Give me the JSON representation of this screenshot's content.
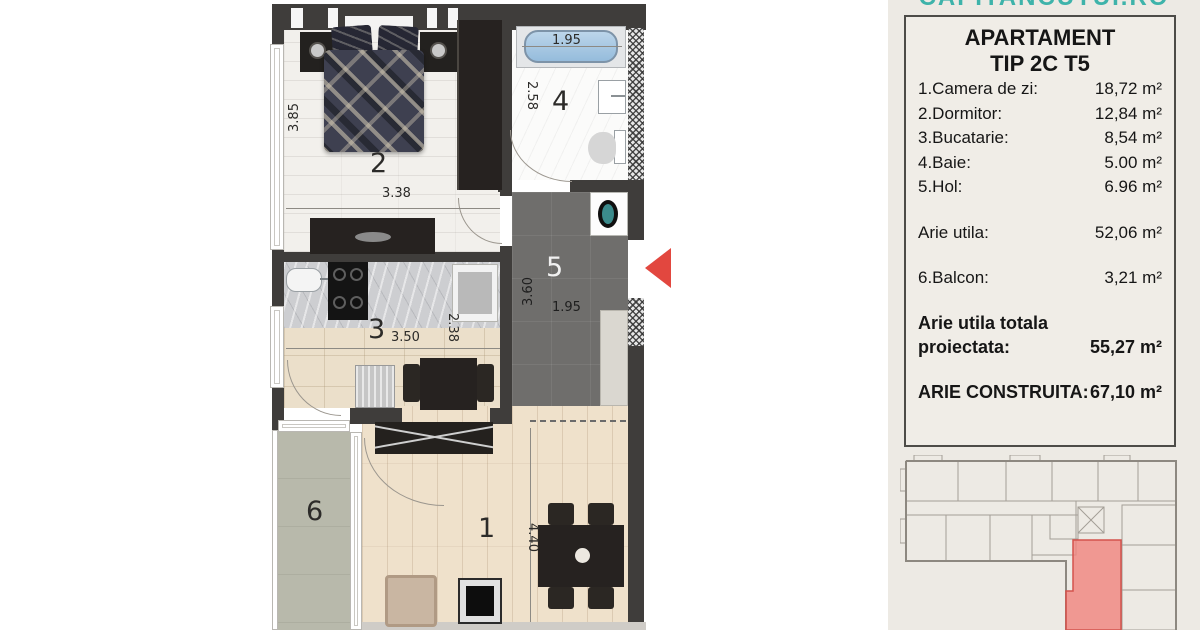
{
  "site": {
    "url_text": "CAPITANCUTUI.RO",
    "url_color": "#3eb3aa"
  },
  "panel": {
    "title_line1": "APARTAMENT",
    "title_line2": "TIP 2C T5",
    "rooms": [
      {
        "label": "1.Camera de zi:",
        "value": "18,72 m²"
      },
      {
        "label": "2.Dormitor:",
        "value": "12,84 m²"
      },
      {
        "label": "3.Bucatarie:",
        "value": "8,54 m²"
      },
      {
        "label": "4.Baie:",
        "value": "5.00 m²"
      },
      {
        "label": "5.Hol:",
        "value": "6.96 m²"
      }
    ],
    "arie_utila": {
      "label": "Arie utila:",
      "value": "52,06 m²"
    },
    "balcon": {
      "label": "6.Balcon:",
      "value": "3,21 m²"
    },
    "totala": {
      "label_line1": "Arie utila totala",
      "label_line2": "proiectata:",
      "value": "55,27 m²"
    },
    "construita": {
      "label": "ARIE CONSTRUITA:",
      "value": "67,10 m²"
    }
  },
  "plan": {
    "room_numbers": {
      "living": "1",
      "dormitor": "2",
      "bucatarie": "3",
      "baie": "4",
      "hol": "5",
      "balcon": "6"
    },
    "dims": {
      "dormitor_w": "3.38",
      "dormitor_h": "3.85",
      "baie_tub": "1.95",
      "baie_h": "2.58",
      "bucatarie_w": "3.50",
      "bucatarie_h": "2.38",
      "hol_h": "3.60",
      "hol_w": "1.95",
      "living_h": "4.40"
    },
    "entrance_arrow_color": "#e2473f",
    "mini": {
      "highlight_fill": "#f0837d",
      "highlight_stroke": "#d4524c",
      "line_color": "#a39e96"
    }
  }
}
